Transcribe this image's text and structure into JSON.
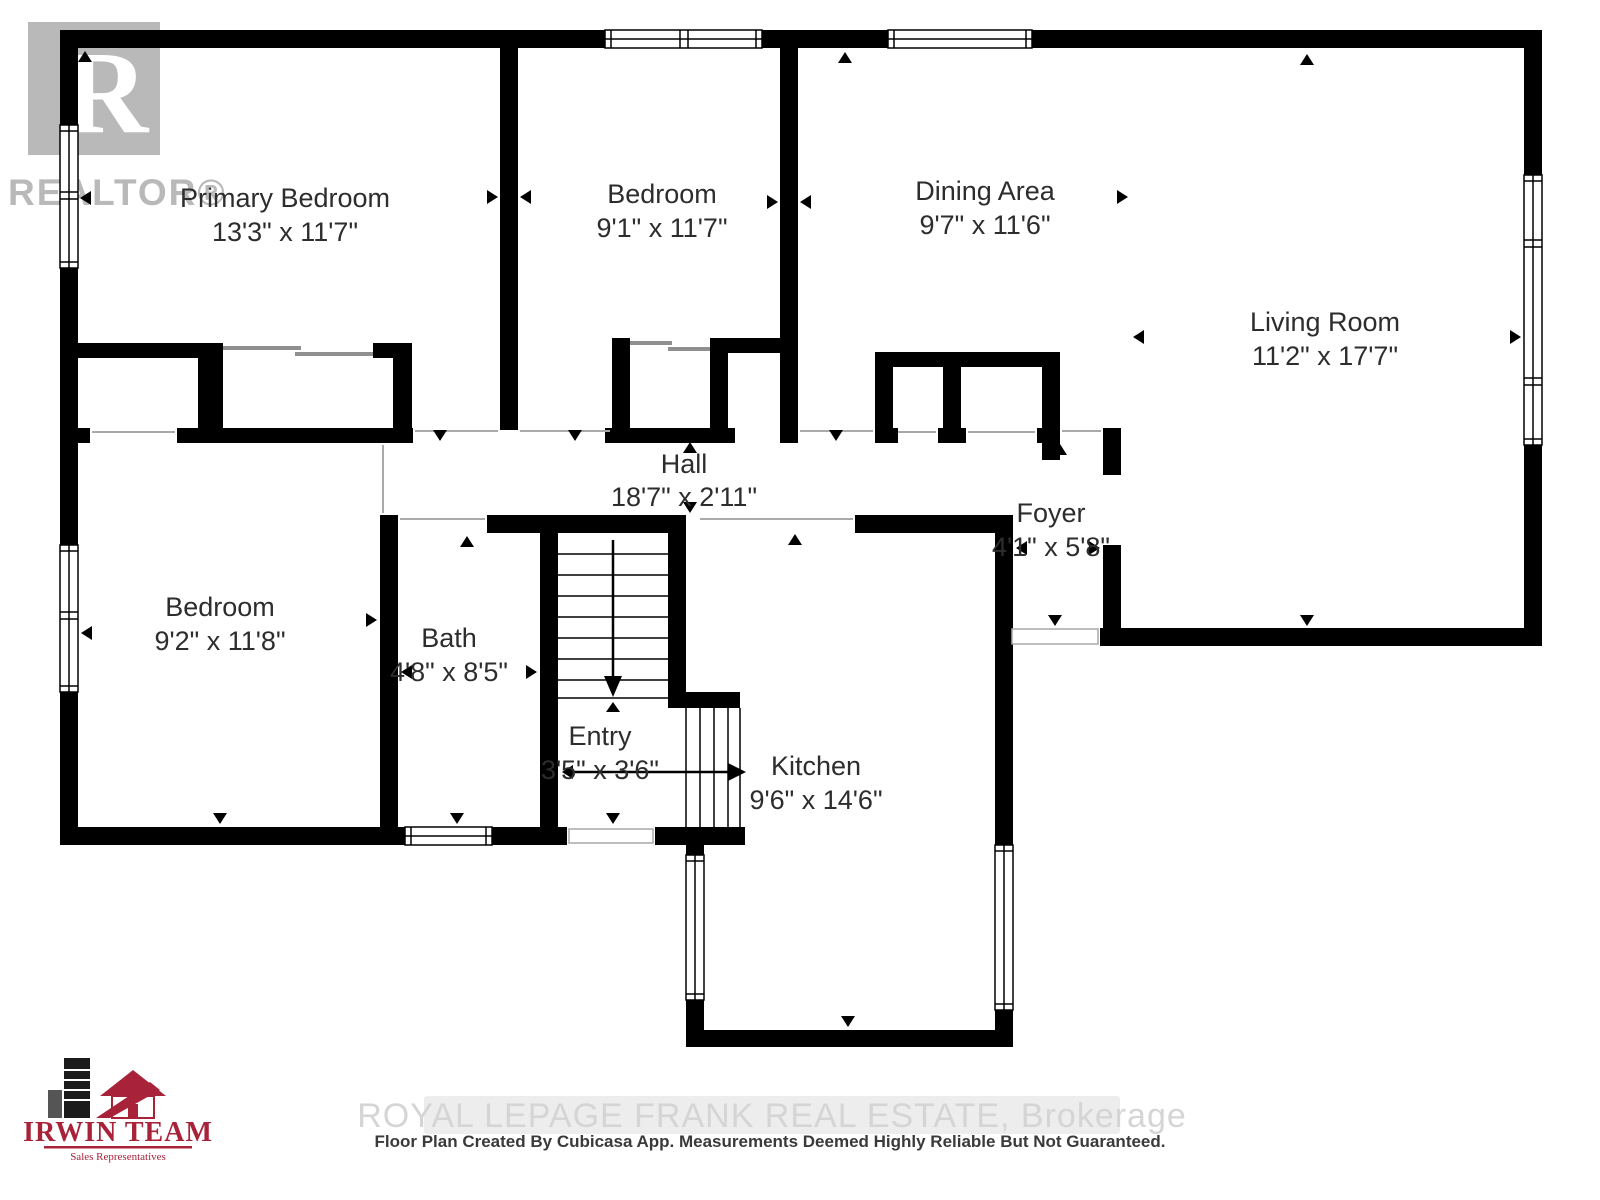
{
  "branding": {
    "realtor_logo": {
      "letter": "R",
      "label": "REALTOR®"
    },
    "irwin": {
      "title": "IRWIN TEAM",
      "subtitle": "Sales Representatives"
    },
    "watermark": "ROYAL LEPAGE FRANK REAL ESTATE, Brokerage",
    "disclaimer": "Floor Plan Created By Cubicasa App. Measurements Deemed Highly Reliable But Not Guaranteed."
  },
  "colors": {
    "wall": "#000000",
    "label_text": "#2d2d2d",
    "logo_gray": "#b9b9b9",
    "brand_red": "#a8233a",
    "watermark_gray": "#d5d5d5"
  },
  "rooms": [
    {
      "name": "Primary Bedroom",
      "dims": "13'3\" x 11'7\""
    },
    {
      "name": "Bedroom",
      "dims": "9'1\" x 11'7\""
    },
    {
      "name": "Dining Area",
      "dims": "9'7\" x 11'6\""
    },
    {
      "name": "Living Room",
      "dims": "11'2\" x 17'7\""
    },
    {
      "name": "Hall",
      "dims": "18'7\" x 2'11\""
    },
    {
      "name": "Foyer",
      "dims": "4'1\" x 5'8\""
    },
    {
      "name": "Bedroom",
      "dims": "9'2\" x 11'8\""
    },
    {
      "name": "Bath",
      "dims": "4'8\" x 8'5\""
    },
    {
      "name": "Entry",
      "dims": "3'5\" x 3'6\""
    },
    {
      "name": "Kitchen",
      "dims": "9'6\" x 14'6\""
    }
  ]
}
